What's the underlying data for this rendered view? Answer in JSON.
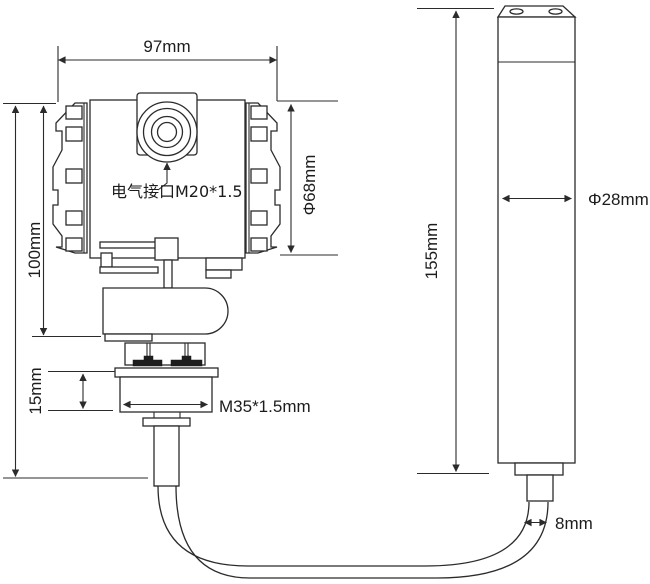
{
  "drawing": {
    "labels": {
      "top_width": "97mm",
      "left_height": "100mm",
      "electrical_interface": "电气接口M20*1.5",
      "head_diameter": "Φ68mm",
      "nut_thickness": "15mm",
      "thread_spec": "M35*1.5mm",
      "probe_length": "155mm",
      "probe_diameter": "Φ28mm",
      "cable_diameter": "8mm"
    },
    "colors": {
      "line": "#2b2b2b",
      "text": "#1c1c1c",
      "background": "#ffffff"
    }
  }
}
